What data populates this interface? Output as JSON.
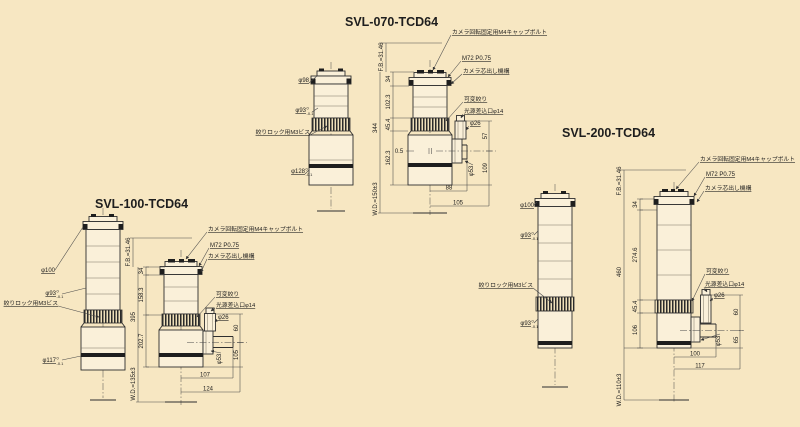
{
  "page": {
    "background": "#f7e7c2"
  },
  "drawings": [
    {
      "title": "SVL-070-TCD64",
      "annotations": {
        "cap_bolt": "カメラ回転固定用M4キャップボルト",
        "mount_thread": "M72 P0.75",
        "centering": "カメラ芯出し機構",
        "iris": "可変絞り",
        "light_port": "光源差込口φ14",
        "light_tube_dia": "φ26",
        "lock_screw": "絞りロック用M3ビス"
      },
      "left_view": {
        "dia_top": "φ98",
        "dia_barrel": "φ93",
        "dia_barrel_tol_hi": "0",
        "dia_barrel_tol_lo": "-0.1",
        "dia_bottom": "φ128",
        "dia_bottom_tol_hi": "0",
        "dia_bottom_tol_lo": "-0.1"
      },
      "dimensions": {
        "flange_back": "F.B.=31.46",
        "seg_mount": "34",
        "seg_upper": "102.3",
        "seg_knurl": "45.4",
        "seg_lower": "162.3",
        "overall": "344",
        "offset": "0.5",
        "working_distance": "W.D.=150±3",
        "port_above": "57",
        "port_below": "109",
        "port_flange_dia": "φ53",
        "width_inner": "88",
        "width_outer": "105"
      }
    },
    {
      "title": "SVL-100-TCD64",
      "annotations": {
        "cap_bolt": "カメラ回転固定用M4キャップボルト",
        "mount_thread": "M72 P0.75",
        "centering": "カメラ芯出し機構",
        "iris": "可変絞り",
        "light_port": "光源差込口φ14",
        "light_tube_dia": "φ26",
        "lock_screw": "絞りロック用M3ビス"
      },
      "left_view": {
        "dia_top": "φ100",
        "dia_barrel": "φ93",
        "dia_barrel_tol_hi": "0",
        "dia_barrel_tol_lo": "-0.1",
        "dia_bottom": "φ117",
        "dia_bottom_tol_hi": "0",
        "dia_bottom_tol_lo": "-0.1"
      },
      "dimensions": {
        "flange_back": "F.B.=31.46",
        "seg_mount": "34",
        "seg_upper": "158.3",
        "seg_lower": "202.7",
        "overall": "395",
        "working_distance": "W.D.=135±3",
        "port_above": "60",
        "port_below": "105",
        "port_flange_dia": "φ53",
        "width_inner": "107",
        "width_outer": "124"
      }
    },
    {
      "title": "SVL-200-TCD64",
      "annotations": {
        "cap_bolt": "カメラ回転固定用M4キャップボルト",
        "mount_thread": "M72 P0.75",
        "centering": "カメラ芯出し機構",
        "iris": "可変絞り",
        "light_port": "光源差込口φ14",
        "light_tube_dia": "φ26",
        "lock_screw": "絞りロック用M3ビス"
      },
      "left_view": {
        "dia_top": "φ100",
        "dia_barrel": "φ93",
        "dia_barrel_tol_hi": "0",
        "dia_barrel_tol_lo": "-0.1",
        "dia_bottom": "φ93",
        "dia_bottom_tol_hi": "0",
        "dia_bottom_tol_lo": "-0.1"
      },
      "dimensions": {
        "flange_back": "F.B.=31.46",
        "seg_mount": "34",
        "seg_upper": "274.6",
        "seg_knurl": "45.4",
        "seg_lower": "106",
        "overall": "460",
        "working_distance": "W.D.=110±3",
        "port_above": "60",
        "port_below": "65",
        "port_flange_dia": "φ53",
        "width_inner": "100",
        "width_outer": "117"
      }
    }
  ]
}
